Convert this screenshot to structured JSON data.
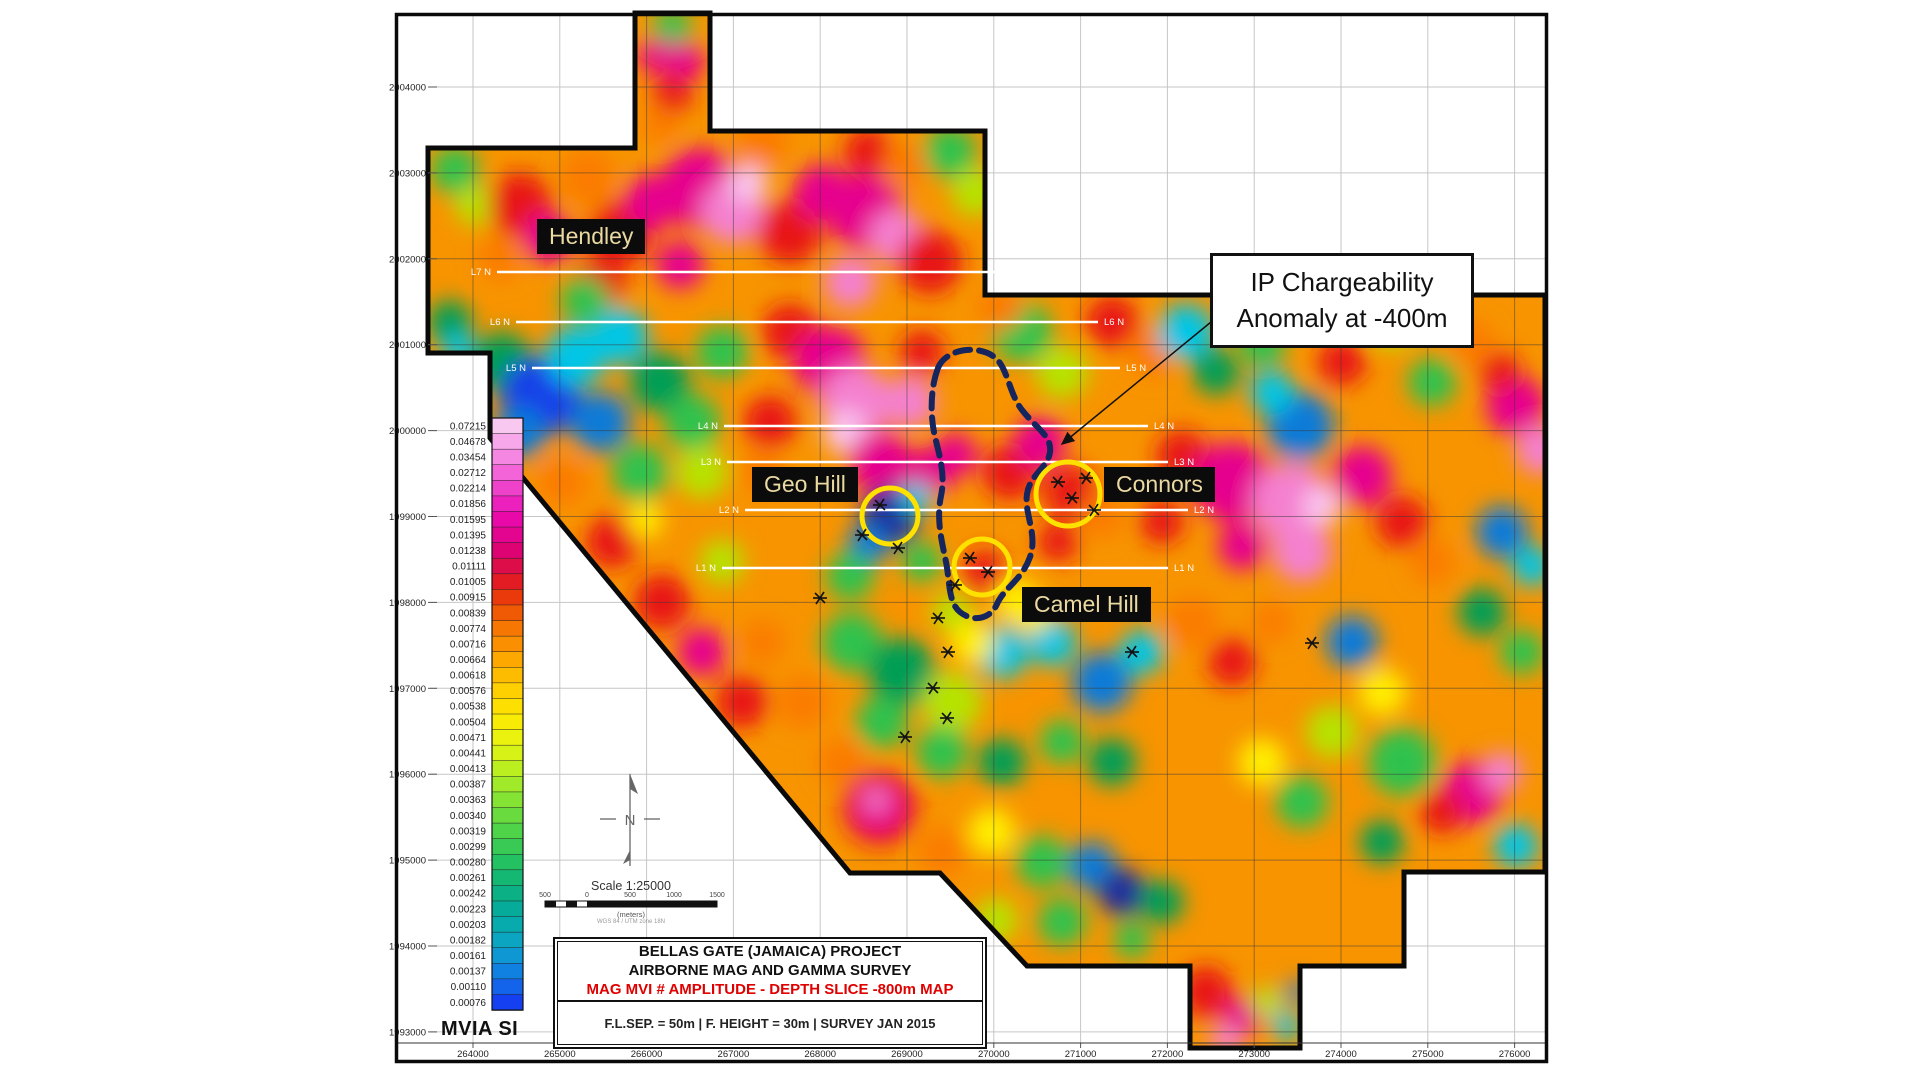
{
  "sheet": {
    "axes": {
      "x_labels": [
        "264000",
        "265000",
        "266000",
        "267000",
        "268000",
        "269000",
        "270000",
        "271000",
        "272000",
        "273000",
        "274000",
        "275000",
        "276000"
      ],
      "y_labels": [
        "2004000",
        "2003000",
        "2002000",
        "2001000",
        "2000000",
        "1999000",
        "1998000",
        "1997000",
        "1996000",
        "1995000",
        "1994000",
        "1993000"
      ]
    },
    "legend": {
      "title": "MVIA SI",
      "values": [
        "0.07215",
        "0.04678",
        "0.03454",
        "0.02712",
        "0.02214",
        "0.01856",
        "0.01595",
        "0.01395",
        "0.01238",
        "0.01111",
        "0.01005",
        "0.00915",
        "0.00839",
        "0.00774",
        "0.00716",
        "0.00664",
        "0.00618",
        "0.00576",
        "0.00538",
        "0.00504",
        "0.00471",
        "0.00441",
        "0.00413",
        "0.00387",
        "0.00363",
        "0.00340",
        "0.00319",
        "0.00299",
        "0.00280",
        "0.00261",
        "0.00242",
        "0.00223",
        "0.00203",
        "0.00182",
        "0.00161",
        "0.00137",
        "0.00110",
        "0.00076"
      ],
      "colors": [
        "#f8c8f0",
        "#f7a8ea",
        "#f586e2",
        "#f264d8",
        "#ef42cb",
        "#ec20bc",
        "#e909a8",
        "#e30590",
        "#dd0373",
        "#dd0d4a",
        "#e21c22",
        "#ea3a0c",
        "#f15a04",
        "#f67701",
        "#fa9001",
        "#fda701",
        "#febc01",
        "#fecf01",
        "#fddf02",
        "#f8ec06",
        "#ebf20e",
        "#d6f216",
        "#bcef1f",
        "#a1ea29",
        "#85e333",
        "#69db3e",
        "#4fd349",
        "#38ca55",
        "#24c163",
        "#15b873",
        "#0bb085",
        "#07ab99",
        "#08abad",
        "#0ba5c2",
        "#0e97d3",
        "#1181e1",
        "#1363eb",
        "#1540f1"
      ]
    },
    "flight_lines": [
      {
        "label": "L7 N",
        "y": 272,
        "x1": 497,
        "x2": 1078
      },
      {
        "label": "L6 N",
        "y": 322,
        "x1": 516,
        "x2": 1098
      },
      {
        "label": "L5 N",
        "y": 368,
        "x1": 532,
        "x2": 1120
      },
      {
        "label": "L4 N",
        "y": 426,
        "x1": 724,
        "x2": 1148
      },
      {
        "label": "L3 N",
        "y": 462,
        "x1": 727,
        "x2": 1168
      },
      {
        "label": "L2 N",
        "y": 510,
        "x1": 745,
        "x2": 1188
      },
      {
        "label": "L1 N",
        "y": 568,
        "x1": 722,
        "x2": 1168
      }
    ],
    "labels": {
      "hendley": "Hendley",
      "geo_hill": "Geo Hill",
      "connors": "Connors",
      "camel_hill": "Camel Hill"
    },
    "annotation": {
      "line1": "IP Chargeability",
      "line2": "Anomaly at -400m"
    },
    "title_block": {
      "line1": "BELLAS GATE (JAMAICA) PROJECT",
      "line2": "AIRBORNE MAG AND GAMMA SURVEY",
      "line3": "MAG MVI # AMPLITUDE - DEPTH SLICE -800m MAP",
      "spec": "F.L.SEP. = 50m |  F. HEIGHT = 30m | SURVEY JAN 2015"
    },
    "scale_bar": {
      "caption": "Scale 1:25000",
      "ticks": [
        "500",
        "0",
        "500",
        "1000",
        "1500"
      ],
      "units": "(meters)",
      "datum": "WGS 84 / UTM zone 18N"
    },
    "colors": {
      "title_red": "#e00000",
      "flight_line": "#ffffff",
      "anomaly_outline": "#16255e",
      "target_circle": "#ffe100",
      "label_text": "#ead9a1"
    }
  }
}
